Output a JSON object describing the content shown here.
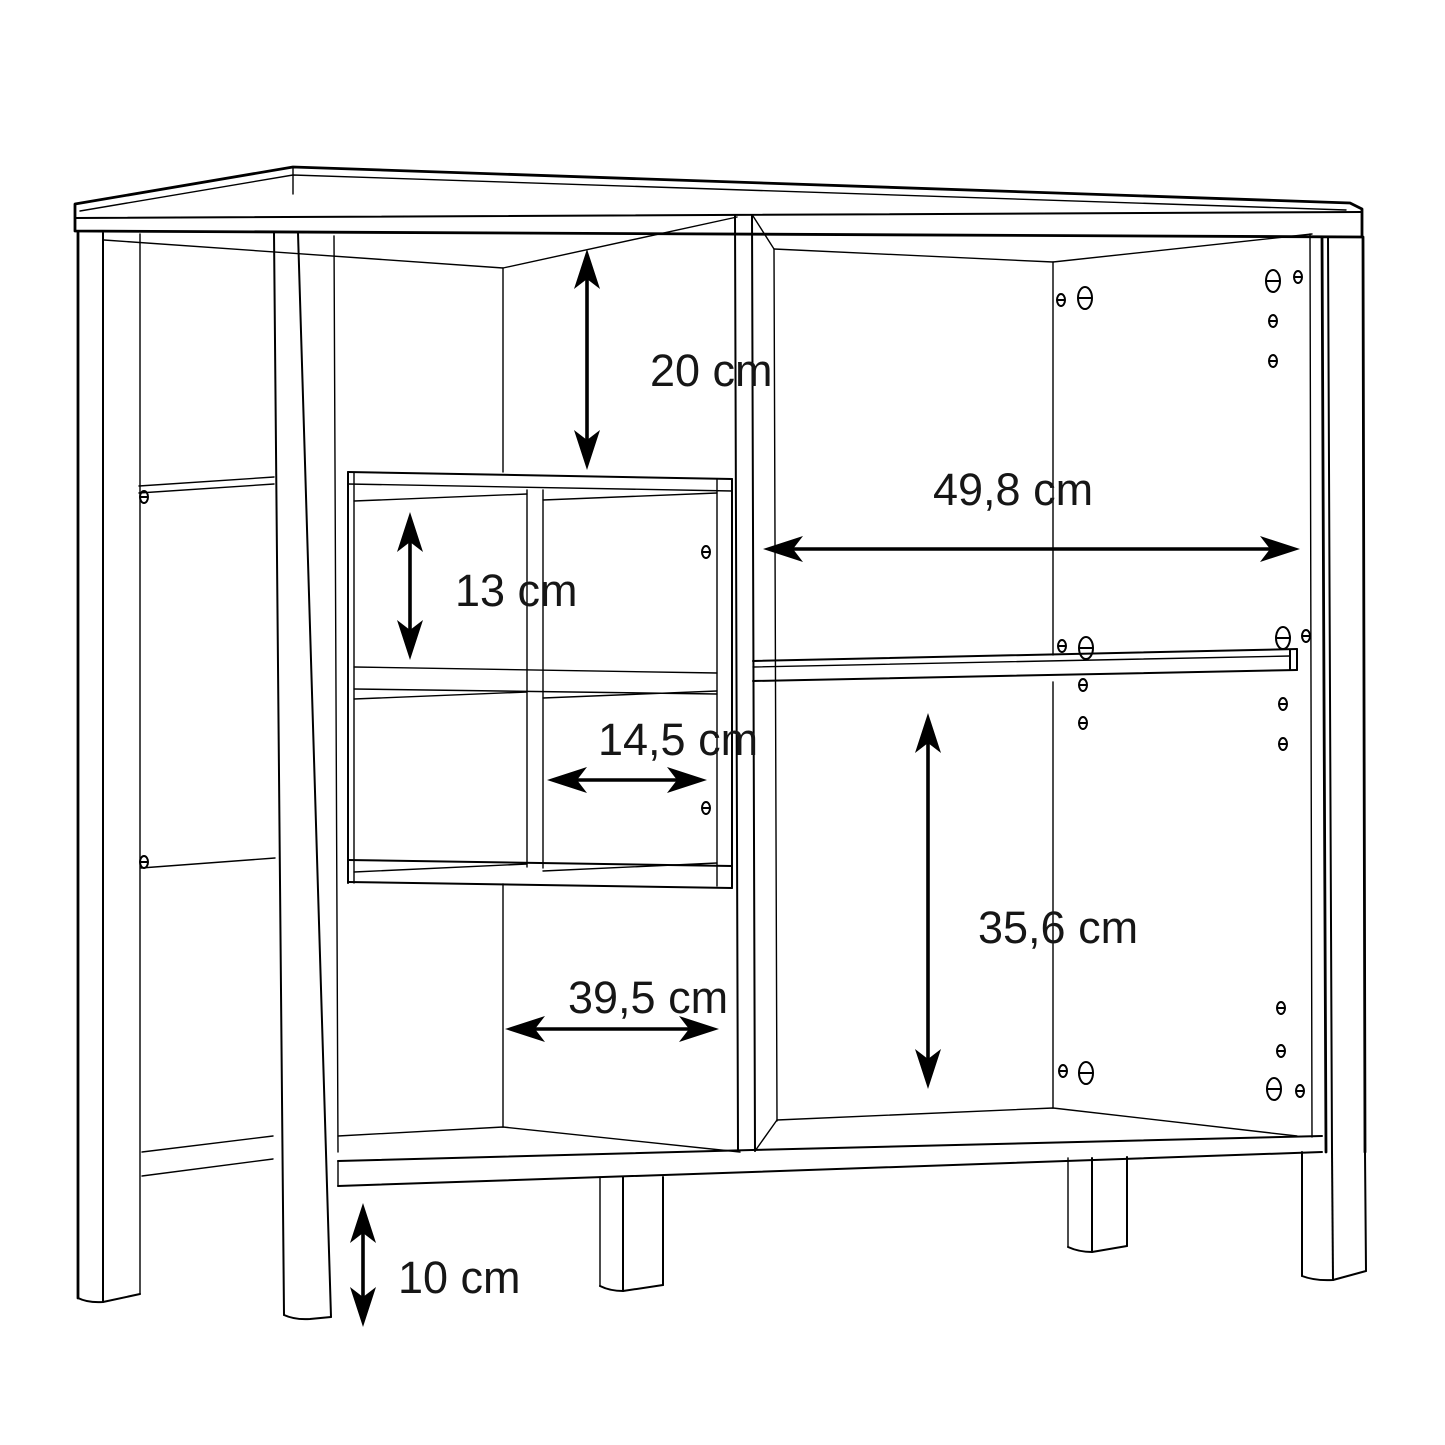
{
  "diagram": {
    "type": "furniture-dimension-diagram",
    "subject": "sideboard-cabinet-line-drawing",
    "unit": "cm",
    "background_color": "#ffffff",
    "line_color": "#000000",
    "dimensions": {
      "top_compartment_height": {
        "value": 20,
        "label": "20 cm",
        "orientation": "vertical"
      },
      "cube_cell_height": {
        "value": 13,
        "label": "13 cm",
        "orientation": "vertical"
      },
      "cube_cell_width": {
        "value": 14.5,
        "label": "14,5 cm",
        "orientation": "horizontal"
      },
      "right_compartment_width": {
        "value": 49.8,
        "label": "49,8 cm",
        "orientation": "horizontal"
      },
      "right_lower_compartment_height": {
        "value": 35.6,
        "label": "35,6 cm",
        "orientation": "vertical"
      },
      "left_lower_compartment_width": {
        "value": 39.5,
        "label": "39,5 cm",
        "orientation": "horizontal"
      },
      "leg_height": {
        "value": 10,
        "label": "10 cm",
        "orientation": "vertical"
      }
    }
  }
}
